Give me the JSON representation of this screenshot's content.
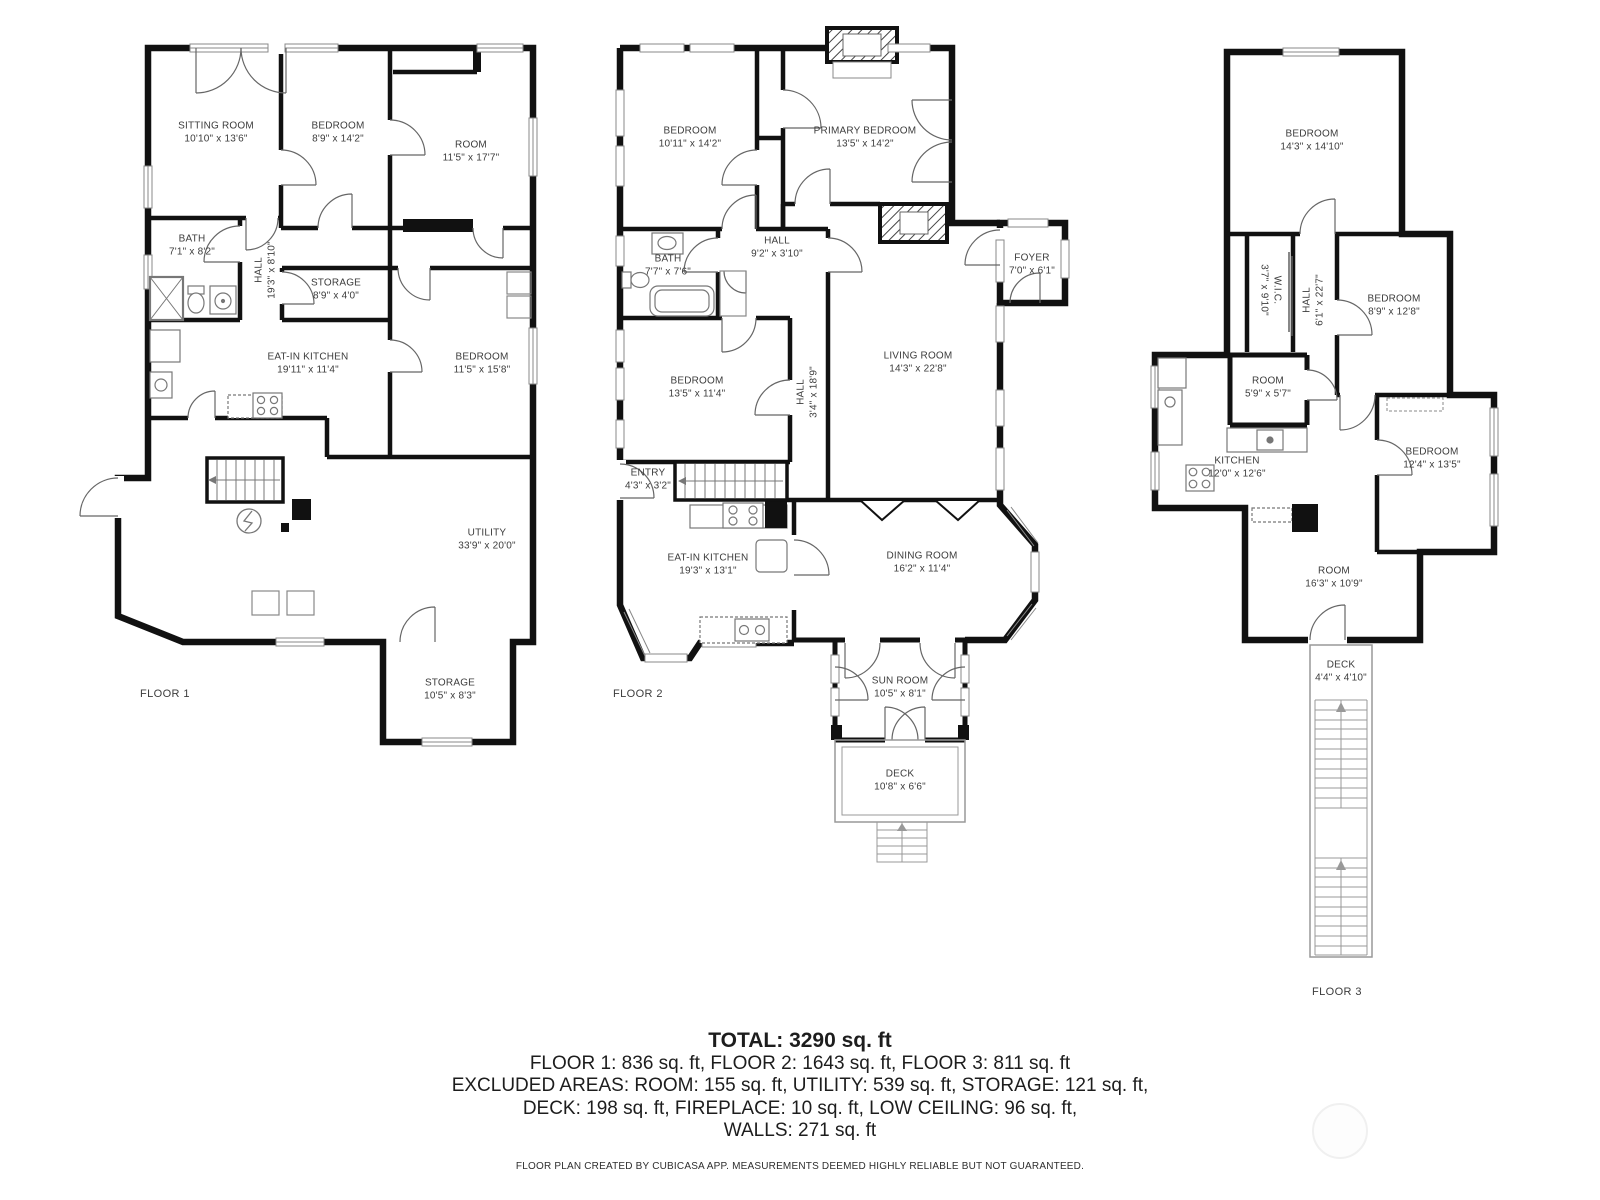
{
  "floors": [
    {
      "label": "FLOOR 1",
      "rooms": [
        {
          "name": "SITTING ROOM",
          "dims": "10'10\" x 13'6\""
        },
        {
          "name": "BEDROOM",
          "dims": "8'9\" x 14'2\""
        },
        {
          "name": "ROOM",
          "dims": "11'5\" x 17'7\""
        },
        {
          "name": "BATH",
          "dims": "7'1\" x 8'2\""
        },
        {
          "name": "HALL",
          "dims": "19'3\" x 8'10\""
        },
        {
          "name": "STORAGE",
          "dims": "8'9\" x 4'0\""
        },
        {
          "name": "EAT-IN KITCHEN",
          "dims": "19'11\" x 11'4\""
        },
        {
          "name": "BEDROOM",
          "dims": "11'5\" x 15'8\""
        },
        {
          "name": "UTILITY",
          "dims": "33'9\" x 20'0\""
        },
        {
          "name": "STORAGE",
          "dims": "10'5\" x 8'3\""
        }
      ]
    },
    {
      "label": "FLOOR 2",
      "rooms": [
        {
          "name": "BEDROOM",
          "dims": "10'11\" x 14'2\""
        },
        {
          "name": "PRIMARY BEDROOM",
          "dims": "13'5\" x 14'2\""
        },
        {
          "name": "BATH",
          "dims": "7'7\" x 7'6\""
        },
        {
          "name": "HALL",
          "dims": "9'2\" x 3'10\""
        },
        {
          "name": "FOYER",
          "dims": "7'0\" x 6'1\""
        },
        {
          "name": "BEDROOM",
          "dims": "13'5\" x 11'4\""
        },
        {
          "name": "HALL",
          "dims": "3'4\" x 18'9\""
        },
        {
          "name": "LIVING ROOM",
          "dims": "14'3\" x 22'8\""
        },
        {
          "name": "ENTRY",
          "dims": "4'3\" x 3'2\""
        },
        {
          "name": "EAT-IN KITCHEN",
          "dims": "19'3\" x 13'1\""
        },
        {
          "name": "DINING ROOM",
          "dims": "16'2\" x 11'4\""
        },
        {
          "name": "SUN ROOM",
          "dims": "10'5\" x 8'1\""
        },
        {
          "name": "DECK",
          "dims": "10'8\" x 6'6\""
        }
      ]
    },
    {
      "label": "FLOOR 3",
      "rooms": [
        {
          "name": "BEDROOM",
          "dims": "14'3\" x 14'10\""
        },
        {
          "name": "W.I.C.",
          "dims": "3'7\" x 9'10\""
        },
        {
          "name": "HALL",
          "dims": "6'1\" x 22'7\""
        },
        {
          "name": "BEDROOM",
          "dims": "8'9\" x 12'8\""
        },
        {
          "name": "ROOM",
          "dims": "5'9\" x 5'7\""
        },
        {
          "name": "KITCHEN",
          "dims": "12'0\" x 12'6\""
        },
        {
          "name": "BEDROOM",
          "dims": "12'4\" x 13'5\""
        },
        {
          "name": "ROOM",
          "dims": "16'3\" x 10'9\""
        },
        {
          "name": "DECK",
          "dims": "4'4\" x 4'10\""
        }
      ]
    }
  ],
  "summary": {
    "total": "TOTAL: 3290 sq. ft",
    "floors_line": "FLOOR 1: 836 sq. ft, FLOOR 2: 1643 sq. ft, FLOOR 3: 811 sq. ft",
    "excluded_line1": "EXCLUDED AREAS: ROOM: 155 sq. ft, UTILITY: 539 sq. ft, STORAGE: 121 sq. ft,",
    "excluded_line2": "DECK: 198 sq. ft, FIREPLACE: 10 sq. ft, LOW CEILING: 96 sq. ft,",
    "walls_line": "WALLS: 271 sq. ft"
  },
  "footer": "FLOOR PLAN CREATED BY CUBICASA APP. MEASUREMENTS DEEMED HIGHLY RELIABLE BUT NOT GUARANTEED.",
  "colors": {
    "wall": "#111111",
    "label_text": "#3c3c3c",
    "thin_line": "#666666"
  }
}
